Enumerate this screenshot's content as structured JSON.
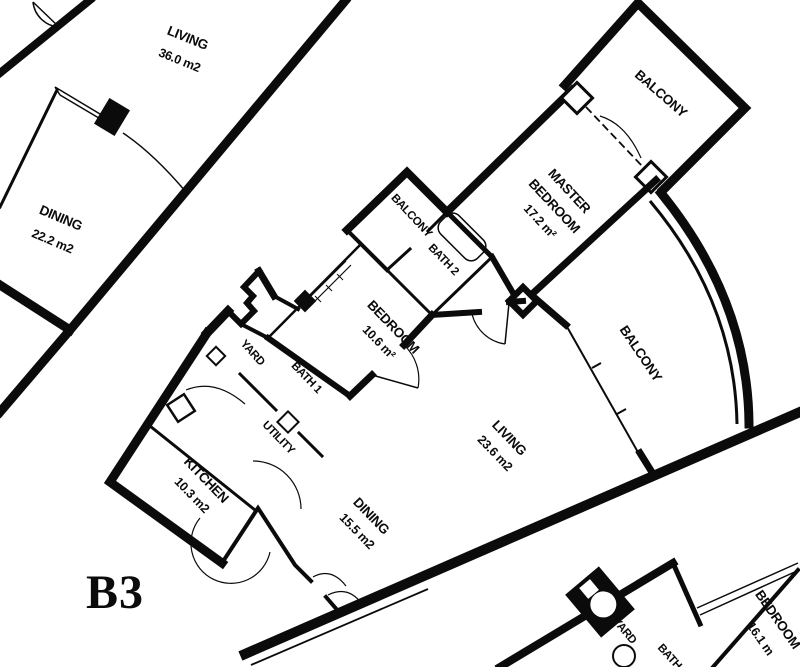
{
  "plan_title": "Apartment floor plan",
  "unit_label": "B3",
  "rooms": {
    "living_tl": {
      "name": "LIVING",
      "area": "36.0 m2"
    },
    "dining_tl": {
      "name": "DINING",
      "area": "22.2 m2"
    },
    "balcony_top": {
      "name": "BALCONY"
    },
    "master": {
      "line1": "MASTER",
      "line2": "BEDROOM",
      "area": "17.2 m²"
    },
    "balcony_small": {
      "name": "BALCONY"
    },
    "bath2": {
      "name": "BATH 2"
    },
    "bedroom": {
      "name": "BEDROOM",
      "area": "10.6 m²"
    },
    "yard": {
      "name": "YARD"
    },
    "bath1": {
      "name": "BATH 1"
    },
    "utility": {
      "name": "UTILITY"
    },
    "kitchen": {
      "name": "KITCHEN",
      "area": "10.3 m2"
    },
    "dining": {
      "name": "DINING",
      "area": "15.5 m2"
    },
    "living": {
      "name": "LIVING",
      "area": "23.6 m2"
    },
    "balcony_right": {
      "name": "BALCONY"
    },
    "yard_br": {
      "name": "YARD"
    },
    "bath_br": {
      "name": "BATH"
    },
    "bedroom_br": {
      "name": "BEDROOM",
      "area": "16.1 m"
    }
  },
  "colors": {
    "ink": "#0b0b0b",
    "paper": "#ffffff"
  }
}
